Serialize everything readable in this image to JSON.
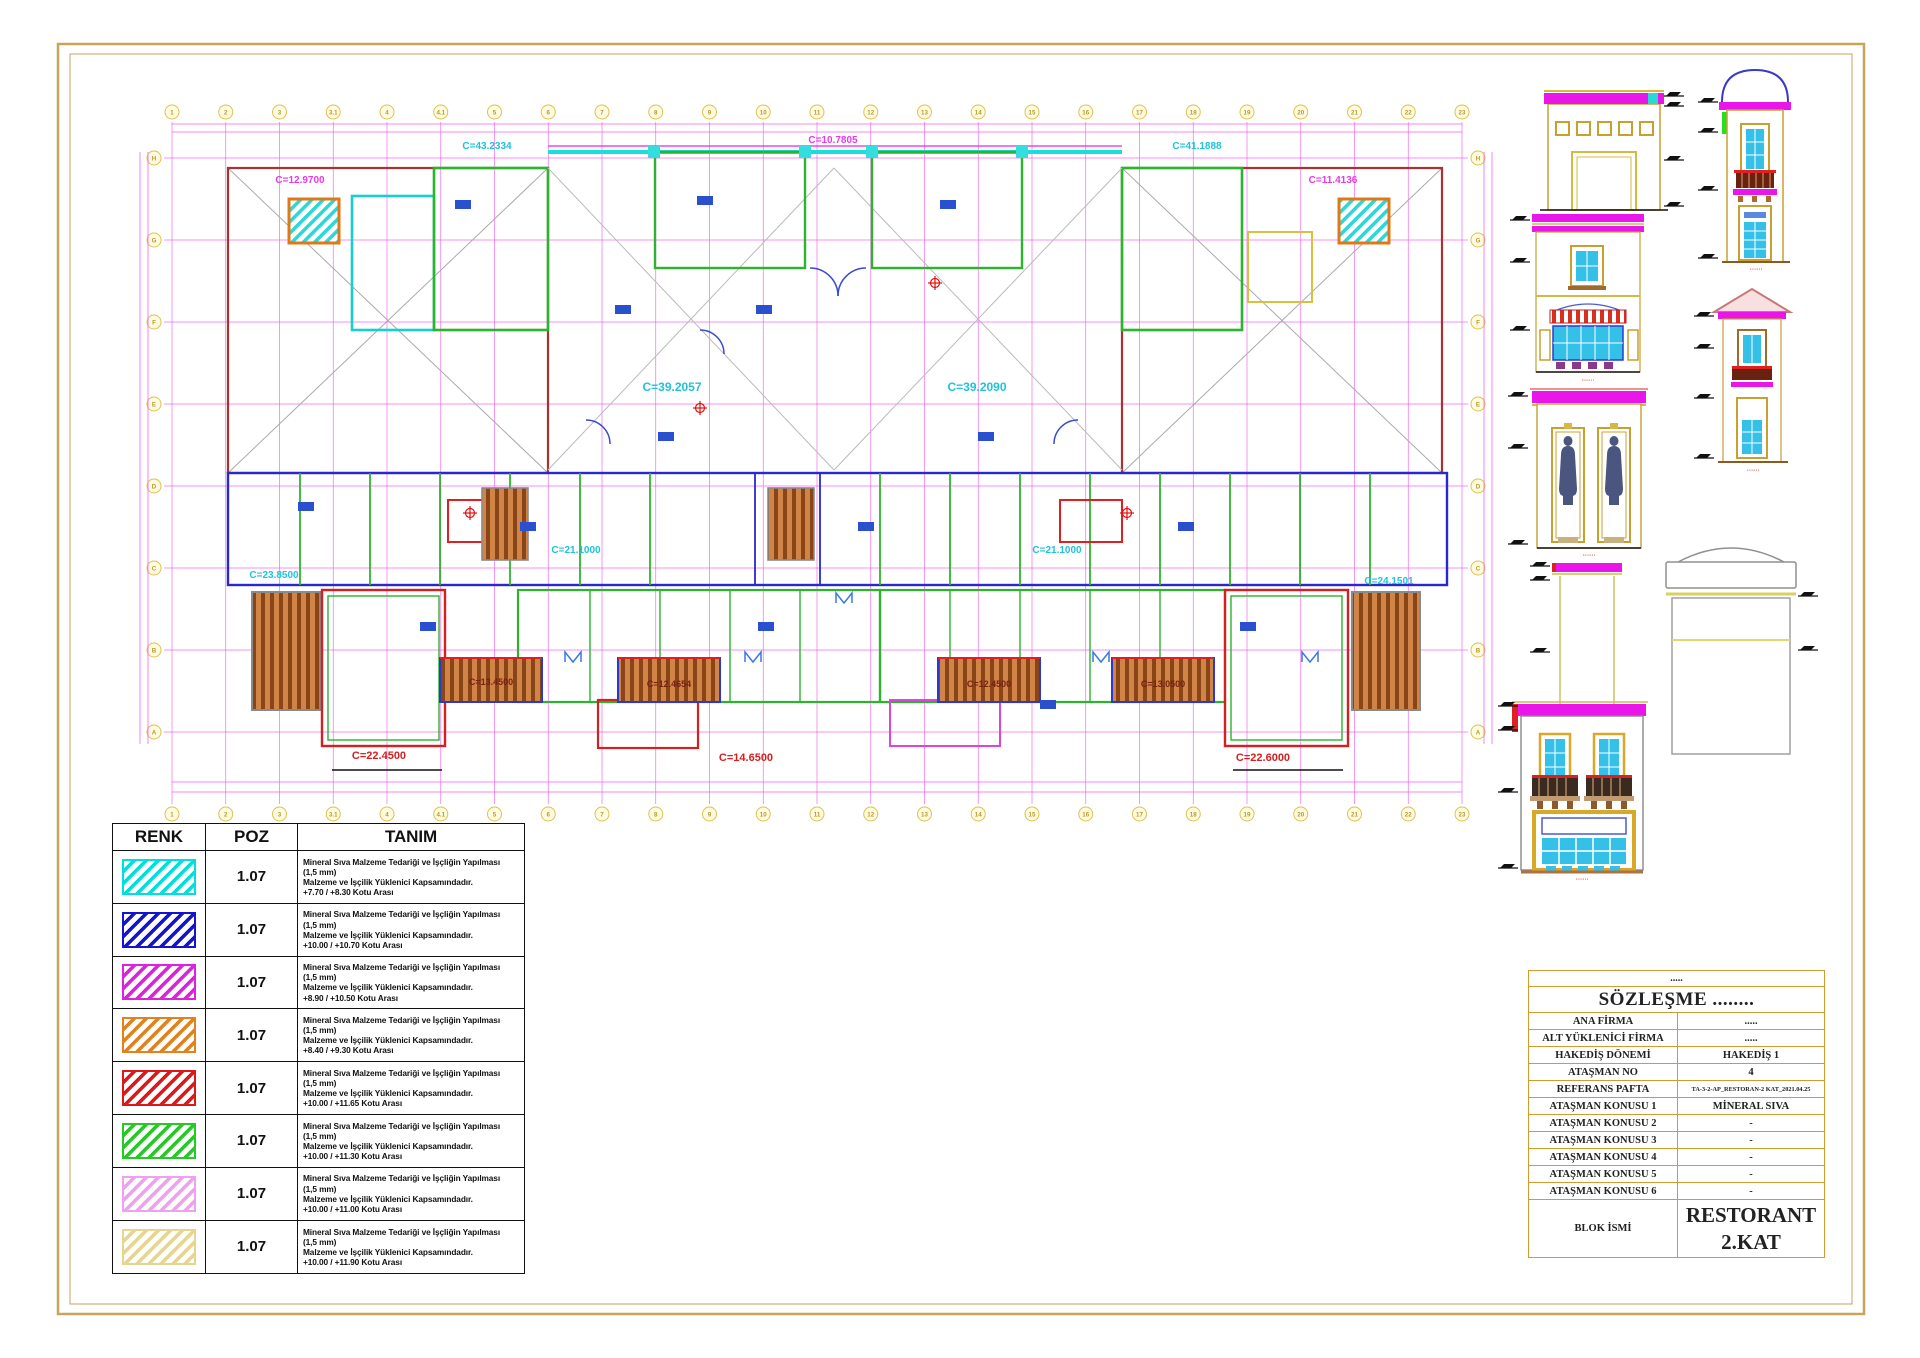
{
  "colors": {
    "frame": "#c9a25c",
    "grid_magenta": "#ee55ee",
    "wall_cyan": "#18cfcf",
    "wall_green": "#2cb42c",
    "wall_blue": "#2828cc",
    "wall_red": "#e02020",
    "wall_orange": "#e07818",
    "band_magenta": "#e816e8",
    "stair_brown": "#b5651d"
  },
  "plan": {
    "grid_top": [
      "1",
      "2",
      "3",
      "3.1",
      "4",
      "4.1",
      "5",
      "6",
      "7",
      "8",
      "9",
      "10",
      "11",
      "12",
      "13",
      "14",
      "15",
      "16",
      "17",
      "18",
      "19",
      "20",
      "21",
      "22",
      "23"
    ],
    "grid_bottom": [
      "1",
      "2",
      "3",
      "3.1",
      "4",
      "4.1",
      "5",
      "6",
      "7",
      "8",
      "9",
      "10",
      "11",
      "12",
      "13",
      "14",
      "15",
      "16",
      "17",
      "18",
      "19",
      "20",
      "21",
      "22",
      "23"
    ],
    "grid_left": [
      "H",
      "G",
      "F",
      "E",
      "D",
      "C",
      "B",
      "A"
    ],
    "grid_right": [
      "H",
      "G",
      "F",
      "E",
      "D",
      "C",
      "B",
      "A"
    ],
    "labels": [
      {
        "text": "C=12.9700"
      },
      {
        "text": "C=43.2334"
      },
      {
        "text": "C=10.7805"
      },
      {
        "text": "C=41.1888"
      },
      {
        "text": "C=11.4136"
      },
      {
        "text": "C=39.2057"
      },
      {
        "text": "C=39.2090"
      },
      {
        "text": "C=21.1000"
      },
      {
        "text": "C=21.1000"
      },
      {
        "text": "C=23.8500"
      },
      {
        "text": "C=24.1501"
      },
      {
        "text": "C=13.4500"
      },
      {
        "text": "C=12.4654"
      },
      {
        "text": "C=12.4500"
      },
      {
        "text": "C=13.0500"
      },
      {
        "text": "C=22.4500"
      },
      {
        "text": "C=14.6500"
      },
      {
        "text": "C=22.6000"
      }
    ]
  },
  "elevations": [
    {
      "name": "front-facade",
      "caption": "·······"
    },
    {
      "name": "tower-dome",
      "caption": "·······"
    },
    {
      "name": "side-facade",
      "caption": "·······"
    },
    {
      "name": "tower-pediment",
      "caption": "·······"
    },
    {
      "name": "statue-niches",
      "caption": "·······"
    },
    {
      "name": "pier",
      "caption": ""
    },
    {
      "name": "dome-structure",
      "caption": ""
    },
    {
      "name": "balcony-storefront",
      "caption": "·······"
    }
  ],
  "legend": {
    "headers": [
      "RENK",
      "POZ",
      "TANIM"
    ],
    "rows": [
      {
        "color": "#00dede",
        "poz": "1.07",
        "line1": "Mineral Sıva Malzeme Tedariği ve İşçliğin Yapılması",
        "line2": "(1,5 mm)",
        "line3": "Malzeme ve İşçilik Yüklenici Kapsamındadır.",
        "line4": "+7.70 / +8.30 Kotu Arası"
      },
      {
        "color": "#1414cc",
        "poz": "1.07",
        "line1": "Mineral Sıva Malzeme Tedariği ve İşçliğin Yapılması",
        "line2": "(1,5 mm)",
        "line3": "Malzeme ve İşçilik Yüklenici Kapsamındadır.",
        "line4": "+10.00 / +10.70 Kotu Arası"
      },
      {
        "color": "#dd22dd",
        "poz": "1.07",
        "line1": "Mineral Sıva Malzeme Tedariği ve İşçliğin Yapılması",
        "line2": "(1,5 mm)",
        "line3": "Malzeme ve İşçilik Yüklenici Kapsamındadır.",
        "line4": "+8.90 / +10.50 Kotu Arası"
      },
      {
        "color": "#e0821e",
        "poz": "1.07",
        "line1": "Mineral Sıva Malzeme Tedariği ve İşçliğin Yapılması",
        "line2": "(1,5 mm)",
        "line3": "Malzeme ve İşçilik Yüklenici Kapsamındadır.",
        "line4": "+8.40 / +9.30 Kotu Arası"
      },
      {
        "color": "#dd1818",
        "poz": "1.07",
        "line1": "Mineral Sıva Malzeme Tedariği ve İşçliğin Yapılması",
        "line2": "(1,5 mm)",
        "line3": "Malzeme ve İşçilik Yüklenici Kapsamındadır.",
        "line4": "+10.00 / +11.65 Kotu Arası"
      },
      {
        "color": "#28c828",
        "poz": "1.07",
        "line1": "Mineral Sıva Malzeme Tedariği ve İşçliğin Yapılması",
        "line2": "(1,5 mm)",
        "line3": "Malzeme ve İşçilik Yüklenici Kapsamındadır.",
        "line4": "+10.00 / +11.30 Kotu Arası"
      },
      {
        "color": "#f0a0f0",
        "poz": "1.07",
        "line1": "Mineral Sıva Malzeme Tedariği ve İşçliğin Yapılması",
        "line2": "(1,5 mm)",
        "line3": "Malzeme ve İşçilik Yüklenici Kapsamındadır.",
        "line4": "+10.00 / +11.00 Kotu Arası"
      },
      {
        "color": "#e6d491",
        "poz": "1.07",
        "line1": "Mineral Sıva Malzeme Tedariği ve İşçliğin Yapılması",
        "line2": "(1,5 mm)",
        "line3": "Malzeme ve İşçilik Yüklenici Kapsamındadır.",
        "line4": "+10.00 / +11.90 Kotu Arası"
      }
    ]
  },
  "titleblock": {
    "dots": ".....",
    "title": "SÖZLEŞME ........",
    "rows": [
      {
        "label": "ANA FİRMA",
        "value": "....."
      },
      {
        "label": "ALT YÜKLENİCİ FİRMA",
        "value": "....."
      },
      {
        "label": "HAKEDİŞ DÖNEMİ",
        "value": "HAKEDİŞ 1"
      },
      {
        "label": "ATAŞMAN NO",
        "value": "4"
      },
      {
        "label": "REFERANS PAFTA",
        "value": "TA-3-2-AP_RESTORAN-2 KAT_2021.04.25"
      },
      {
        "label": "ATAŞMAN KONUSU 1",
        "value": "MİNERAL SIVA"
      },
      {
        "label": "ATAŞMAN KONUSU 2",
        "value": "-"
      },
      {
        "label": "ATAŞMAN KONUSU 3",
        "value": "-"
      },
      {
        "label": "ATAŞMAN KONUSU 4",
        "value": "-"
      },
      {
        "label": "ATAŞMAN KONUSU 5",
        "value": "-"
      },
      {
        "label": "ATAŞMAN KONUSU 6",
        "value": "-"
      },
      {
        "label": "BLOK İSMİ",
        "value": "RESTORANT\n2.KAT"
      }
    ]
  }
}
